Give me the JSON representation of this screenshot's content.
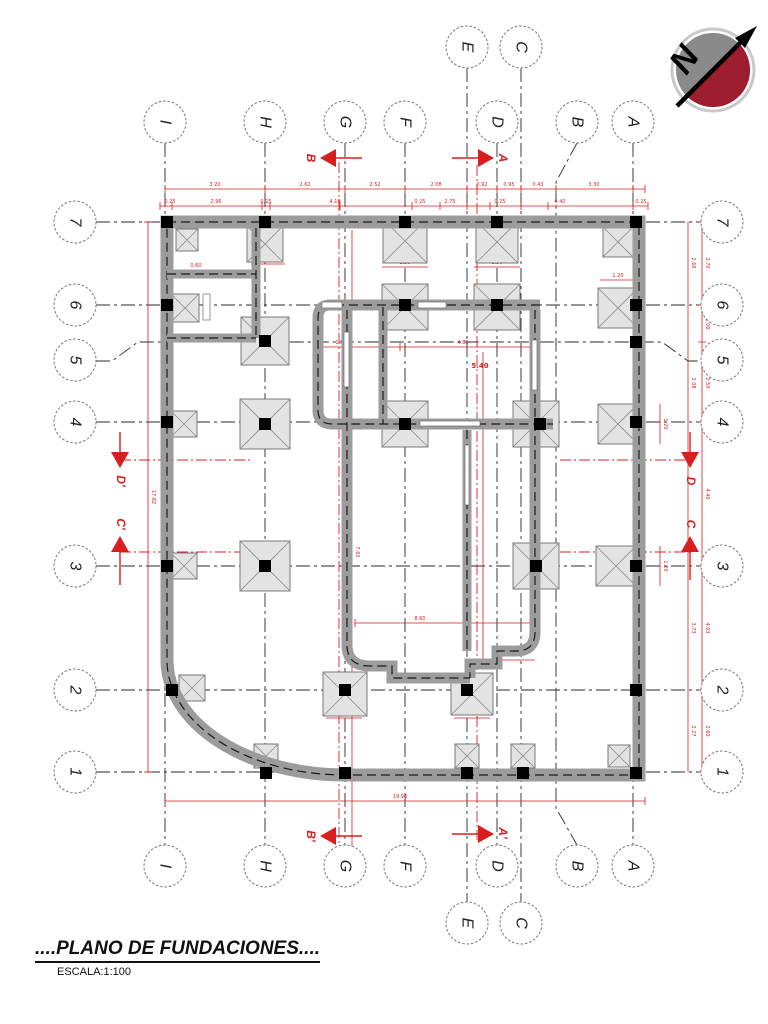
{
  "title": {
    "main": "....PLANO DE FUNDACIONES....",
    "scale": "ESCALA:1:100"
  },
  "north": {
    "label": "N"
  },
  "grid": {
    "cols": [
      {
        "label": "I"
      },
      {
        "label": "H"
      },
      {
        "label": "G"
      },
      {
        "label": "F"
      },
      {
        "label": "E"
      },
      {
        "label": "D"
      },
      {
        "label": "C"
      },
      {
        "label": "B"
      },
      {
        "label": "A"
      }
    ],
    "rows": [
      {
        "label": "7"
      },
      {
        "label": "6"
      },
      {
        "label": "5"
      },
      {
        "label": "4"
      },
      {
        "label": "3"
      },
      {
        "label": "2"
      },
      {
        "label": "1"
      }
    ]
  },
  "sections": {
    "top_b": "B",
    "top_a": "A",
    "bottom_b": "B'",
    "bottom_a": "A'",
    "left_d": "D'",
    "left_c": "C'",
    "right_d": "D",
    "right_c": "C"
  },
  "dims": {
    "top_outer": [
      "3.20",
      "2.62",
      "2.52",
      "2.08",
      "0.92",
      "0.95",
      "0.43",
      "3.30"
    ],
    "top_inner": [
      "0.25",
      "2.96",
      "0.25",
      "4.10",
      "0.25",
      "2.75",
      "0.25",
      "4.40",
      "0.25"
    ],
    "right_outer": [
      "2.70",
      "1.00",
      "2.50",
      "4.40",
      "4.03",
      "2.60"
    ],
    "right_inner": [
      "2.66",
      "3.08",
      "3.73",
      "2.27"
    ],
    "left_total": "17.82",
    "bottom_total": "19.98",
    "d860": "8.60",
    "d762": "7.62",
    "d540": "5.40",
    "d480": "4.80",
    "d150": "1.50",
    "small": [
      "1.50",
      "1.50",
      "0.80",
      "1.20",
      "1.50",
      "1.50",
      "1.50",
      "1.20",
      "1.20",
      "0.80",
      "0.60",
      "0.90"
    ]
  },
  "colors": {
    "dimension_red": "#d81f1f",
    "wall_gray": "#9c9c9c",
    "footing_gray": "#e3e3e3",
    "column_black": "#000000",
    "north_red": "#9d1c2e",
    "north_gray": "#8a8a8a"
  }
}
